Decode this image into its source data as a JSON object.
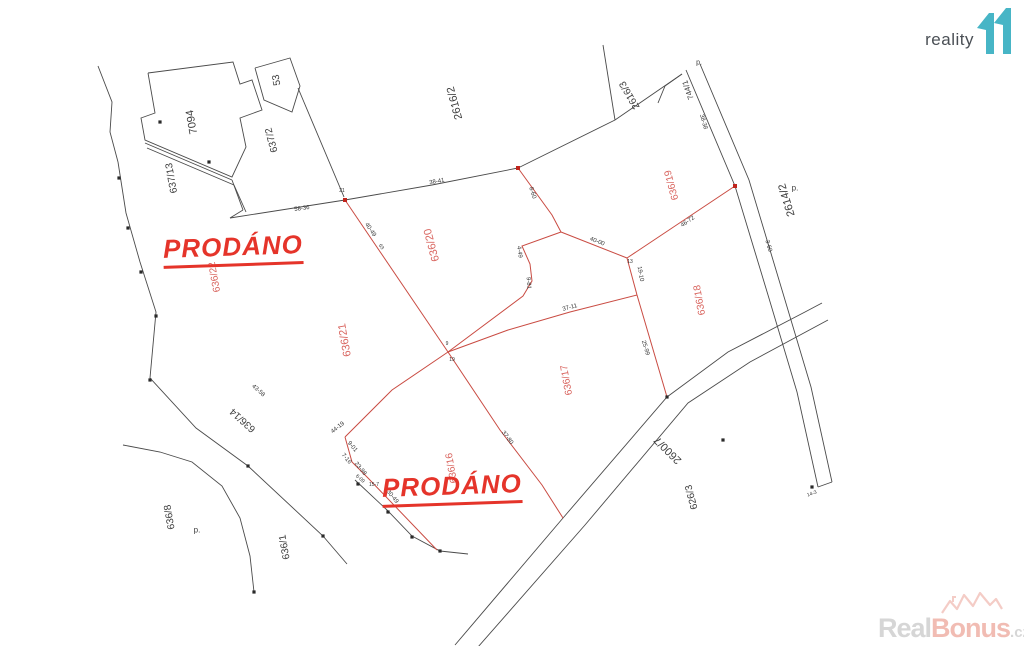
{
  "logo": {
    "text": "reality",
    "accent_color": "#47b5c6"
  },
  "watermark": {
    "real": "Real",
    "bonus": "Bonus",
    "tld": ".cz",
    "house_color": "#f3c7c0"
  },
  "prodano": {
    "label1": "PRODÁNO",
    "label2": "PRODÁNO",
    "color": "#e5342a"
  },
  "map": {
    "colors": {
      "line_black": "#4a4a4a",
      "line_red": "#c94b42",
      "label_red": "#d9655f",
      "label_black": "#3d3d3d",
      "tiny_black": "#333333"
    },
    "parcel_labels": [
      {
        "t": "7094",
        "x": 192,
        "y": 122,
        "r": -100,
        "c": "black",
        "s": 11
      },
      {
        "t": "53",
        "x": 277,
        "y": 80,
        "r": -100,
        "c": "black",
        "s": 10
      },
      {
        "t": "637/2",
        "x": 272,
        "y": 140,
        "r": -105,
        "c": "black",
        "s": 10
      },
      {
        "t": "637/13",
        "x": 172,
        "y": 178,
        "r": -100,
        "c": "black",
        "s": 10
      },
      {
        "t": "2616/2",
        "x": 455,
        "y": 103,
        "r": -105,
        "c": "black",
        "s": 11
      },
      {
        "t": "2616/3",
        "x": 630,
        "y": 95,
        "r": -120,
        "c": "black",
        "s": 10
      },
      {
        "t": "744/1",
        "x": 688,
        "y": 90,
        "r": -110,
        "c": "black",
        "s": 8
      },
      {
        "t": "2614/2",
        "x": 787,
        "y": 200,
        "r": -107,
        "c": "black",
        "s": 11
      },
      {
        "t": "636/19",
        "x": 672,
        "y": 185,
        "r": -105,
        "c": "red",
        "s": 10
      },
      {
        "t": "636/18",
        "x": 700,
        "y": 300,
        "r": -100,
        "c": "red",
        "s": 10
      },
      {
        "t": "636/20",
        "x": 432,
        "y": 245,
        "r": -105,
        "c": "red",
        "s": 11
      },
      {
        "t": "636/21",
        "x": 345,
        "y": 340,
        "r": -100,
        "c": "red",
        "s": 11
      },
      {
        "t": "636/22",
        "x": 215,
        "y": 277,
        "r": -100,
        "c": "red",
        "s": 10
      },
      {
        "t": "636/17",
        "x": 567,
        "y": 380,
        "r": -100,
        "c": "red",
        "s": 10
      },
      {
        "t": "636/16",
        "x": 452,
        "y": 468,
        "r": -100,
        "c": "red",
        "s": 10
      },
      {
        "t": "636/14",
        "x": 243,
        "y": 420,
        "r": -138,
        "c": "black",
        "s": 10
      },
      {
        "t": "636/8",
        "x": 170,
        "y": 517,
        "r": -100,
        "c": "black",
        "s": 10
      },
      {
        "t": "636/1",
        "x": 285,
        "y": 547,
        "r": -100,
        "c": "black",
        "s": 10
      },
      {
        "t": "2600/7",
        "x": 668,
        "y": 450,
        "r": -135,
        "c": "black",
        "s": 11
      },
      {
        "t": "626/3",
        "x": 692,
        "y": 497,
        "r": -105,
        "c": "black",
        "s": 10
      },
      {
        "t": "p.",
        "x": 197,
        "y": 530,
        "r": 0,
        "c": "black",
        "s": 8
      },
      {
        "t": "p.",
        "x": 795,
        "y": 188,
        "r": 0,
        "c": "black",
        "s": 8
      },
      {
        "t": "p.",
        "x": 699,
        "y": 63,
        "r": 0,
        "c": "black",
        "s": 7
      }
    ],
    "measurement_labels": [
      {
        "t": "58-36",
        "x": 302,
        "y": 209,
        "r": -8,
        "s": 6
      },
      {
        "t": "38-41",
        "x": 437,
        "y": 182,
        "r": -10,
        "s": 6
      },
      {
        "t": "40-49",
        "x": 370,
        "y": 230,
        "r": 56,
        "s": 6
      },
      {
        "t": "63",
        "x": 381,
        "y": 247,
        "r": 56,
        "s": 5
      },
      {
        "t": "19",
        "x": 452,
        "y": 360,
        "r": 0,
        "s": 5
      },
      {
        "t": "40-00",
        "x": 597,
        "y": 242,
        "r": 21,
        "s": 6
      },
      {
        "t": "19-10",
        "x": 640,
        "y": 274,
        "r": 80,
        "s": 6
      },
      {
        "t": "37-11",
        "x": 570,
        "y": 308,
        "r": -15,
        "s": 6
      },
      {
        "t": "25-99",
        "x": 645,
        "y": 348,
        "r": 73,
        "s": 6
      },
      {
        "t": "46-72",
        "x": 688,
        "y": 222,
        "r": -34,
        "s": 6
      },
      {
        "t": "38-38",
        "x": 703,
        "y": 122,
        "r": 74,
        "s": 6
      },
      {
        "t": "3-60",
        "x": 768,
        "y": 246,
        "r": 74,
        "s": 6
      },
      {
        "t": "14-3",
        "x": 812,
        "y": 494,
        "r": -20,
        "s": 5
      },
      {
        "t": "8-60",
        "x": 532,
        "y": 193,
        "r": 72,
        "s": 6
      },
      {
        "t": "4-49",
        "x": 519,
        "y": 252,
        "r": 82,
        "s": 6
      },
      {
        "t": "9-81",
        "x": 528,
        "y": 283,
        "r": 86,
        "s": 6
      },
      {
        "t": "44-19",
        "x": 338,
        "y": 428,
        "r": -38,
        "s": 6
      },
      {
        "t": "9-01",
        "x": 352,
        "y": 447,
        "r": 50,
        "s": 6
      },
      {
        "t": "7-16",
        "x": 346,
        "y": 459,
        "r": 50,
        "s": 6
      },
      {
        "t": "23-98",
        "x": 360,
        "y": 469,
        "r": 51,
        "s": 6
      },
      {
        "t": "37-80",
        "x": 507,
        "y": 438,
        "r": 53,
        "s": 6
      },
      {
        "t": "30-49",
        "x": 392,
        "y": 497,
        "r": 51,
        "s": 6
      },
      {
        "t": "15-7",
        "x": 374,
        "y": 485,
        "r": 0,
        "s": 5
      },
      {
        "t": "6-09",
        "x": 360,
        "y": 479,
        "r": 40,
        "s": 5
      },
      {
        "t": "43-58",
        "x": 258,
        "y": 391,
        "r": 42,
        "s": 6
      },
      {
        "t": "21",
        "x": 342,
        "y": 191,
        "r": 0,
        "s": 5
      },
      {
        "t": "13",
        "x": 630,
        "y": 262,
        "r": 0,
        "s": 5
      },
      {
        "t": "9",
        "x": 447,
        "y": 344,
        "r": 0,
        "s": 5
      }
    ],
    "black_polylines": [
      [
        [
          230,
          218
        ],
        [
          345,
          200
        ],
        [
          432,
          185
        ],
        [
          518,
          168
        ]
      ],
      [
        [
          518,
          168
        ],
        [
          615,
          120
        ],
        [
          682,
          74
        ]
      ],
      [
        [
          603,
          45
        ],
        [
          615,
          120
        ]
      ],
      [
        [
          686,
          70
        ],
        [
          735,
          186
        ],
        [
          768,
          295
        ],
        [
          797,
          392
        ],
        [
          818,
          487
        ]
      ],
      [
        [
          700,
          64
        ],
        [
          749,
          180
        ],
        [
          782,
          290
        ],
        [
          811,
          387
        ],
        [
          832,
          482
        ]
      ],
      [
        [
          818,
          487
        ],
        [
          832,
          482
        ]
      ],
      [
        [
          682,
          74
        ],
        [
          665,
          86
        ],
        [
          658,
          103
        ]
      ],
      [
        [
          118,
          162
        ],
        [
          126,
          213
        ],
        [
          140,
          262
        ],
        [
          156,
          312
        ],
        [
          150,
          378
        ],
        [
          196,
          428
        ],
        [
          248,
          466
        ],
        [
          323,
          536
        ],
        [
          347,
          564
        ]
      ],
      [
        [
          123,
          445
        ],
        [
          160,
          452
        ],
        [
          192,
          462
        ],
        [
          222,
          486
        ],
        [
          240,
          518
        ],
        [
          250,
          556
        ],
        [
          254,
          592
        ]
      ],
      [
        [
          98,
          66
        ],
        [
          112,
          102
        ],
        [
          110,
          132
        ],
        [
          118,
          162
        ]
      ],
      [
        [
          148,
          73
        ],
        [
          233,
          62
        ],
        [
          240,
          84
        ],
        [
          252,
          80
        ],
        [
          262,
          110
        ],
        [
          240,
          118
        ],
        [
          246,
          147
        ],
        [
          232,
          177
        ],
        [
          145,
          140
        ],
        [
          141,
          118
        ],
        [
          155,
          113
        ],
        [
          148,
          73
        ]
      ],
      [
        [
          145,
          143
        ],
        [
          232,
          180
        ]
      ],
      [
        [
          147,
          148
        ],
        [
          234,
          185
        ]
      ],
      [
        [
          232,
          180
        ],
        [
          243,
          210
        ]
      ],
      [
        [
          234,
          185
        ],
        [
          246,
          212
        ]
      ],
      [
        [
          243,
          210
        ],
        [
          230,
          218
        ]
      ],
      [
        [
          255,
          68
        ],
        [
          290,
          58
        ],
        [
          300,
          86
        ],
        [
          292,
          112
        ],
        [
          264,
          100
        ],
        [
          255,
          68
        ]
      ],
      [
        [
          298,
          88
        ],
        [
          344,
          197
        ]
      ],
      [
        [
          455,
          645
        ],
        [
          563,
          518
        ],
        [
          667,
          397
        ],
        [
          728,
          352
        ],
        [
          805,
          312
        ],
        [
          822,
          303
        ]
      ],
      [
        [
          478,
          647
        ],
        [
          585,
          525
        ],
        [
          688,
          403
        ],
        [
          750,
          362
        ],
        [
          828,
          320
        ]
      ],
      [
        [
          355,
          480
        ],
        [
          387,
          510
        ],
        [
          412,
          536
        ],
        [
          440,
          551
        ],
        [
          468,
          554
        ]
      ]
    ],
    "red_polylines": [
      [
        [
          345,
          200
        ],
        [
          448,
          352
        ]
      ],
      [
        [
          448,
          352
        ],
        [
          392,
          390
        ],
        [
          345,
          437
        ]
      ],
      [
        [
          345,
          437
        ],
        [
          352,
          462
        ],
        [
          368,
          478
        ],
        [
          437,
          550
        ]
      ],
      [
        [
          448,
          352
        ],
        [
          500,
          430
        ],
        [
          542,
          485
        ],
        [
          563,
          518
        ]
      ],
      [
        [
          518,
          168
        ],
        [
          552,
          215
        ],
        [
          561,
          232
        ]
      ],
      [
        [
          561,
          232
        ],
        [
          522,
          246
        ],
        [
          530,
          264
        ],
        [
          532,
          281
        ],
        [
          523,
          296
        ],
        [
          448,
          352
        ]
      ],
      [
        [
          561,
          232
        ],
        [
          627,
          258
        ]
      ],
      [
        [
          627,
          258
        ],
        [
          735,
          186
        ]
      ],
      [
        [
          627,
          258
        ],
        [
          637,
          295
        ]
      ],
      [
        [
          637,
          295
        ],
        [
          570,
          312
        ],
        [
          508,
          330
        ],
        [
          448,
          352
        ]
      ],
      [
        [
          637,
          295
        ],
        [
          667,
          397
        ]
      ]
    ],
    "black_dots": [
      [
        119,
        178
      ],
      [
        128,
        228
      ],
      [
        141,
        272
      ],
      [
        156,
        316
      ],
      [
        150,
        380
      ],
      [
        248,
        466
      ],
      [
        323,
        536
      ],
      [
        358,
        484
      ],
      [
        388,
        512
      ],
      [
        412,
        537
      ],
      [
        440,
        551
      ],
      [
        667,
        397
      ],
      [
        723,
        440
      ],
      [
        812,
        487
      ],
      [
        160,
        122
      ],
      [
        209,
        162
      ],
      [
        254,
        592
      ]
    ],
    "red_dots": [
      [
        345,
        200
      ],
      [
        518,
        168
      ],
      [
        735,
        186
      ]
    ]
  }
}
